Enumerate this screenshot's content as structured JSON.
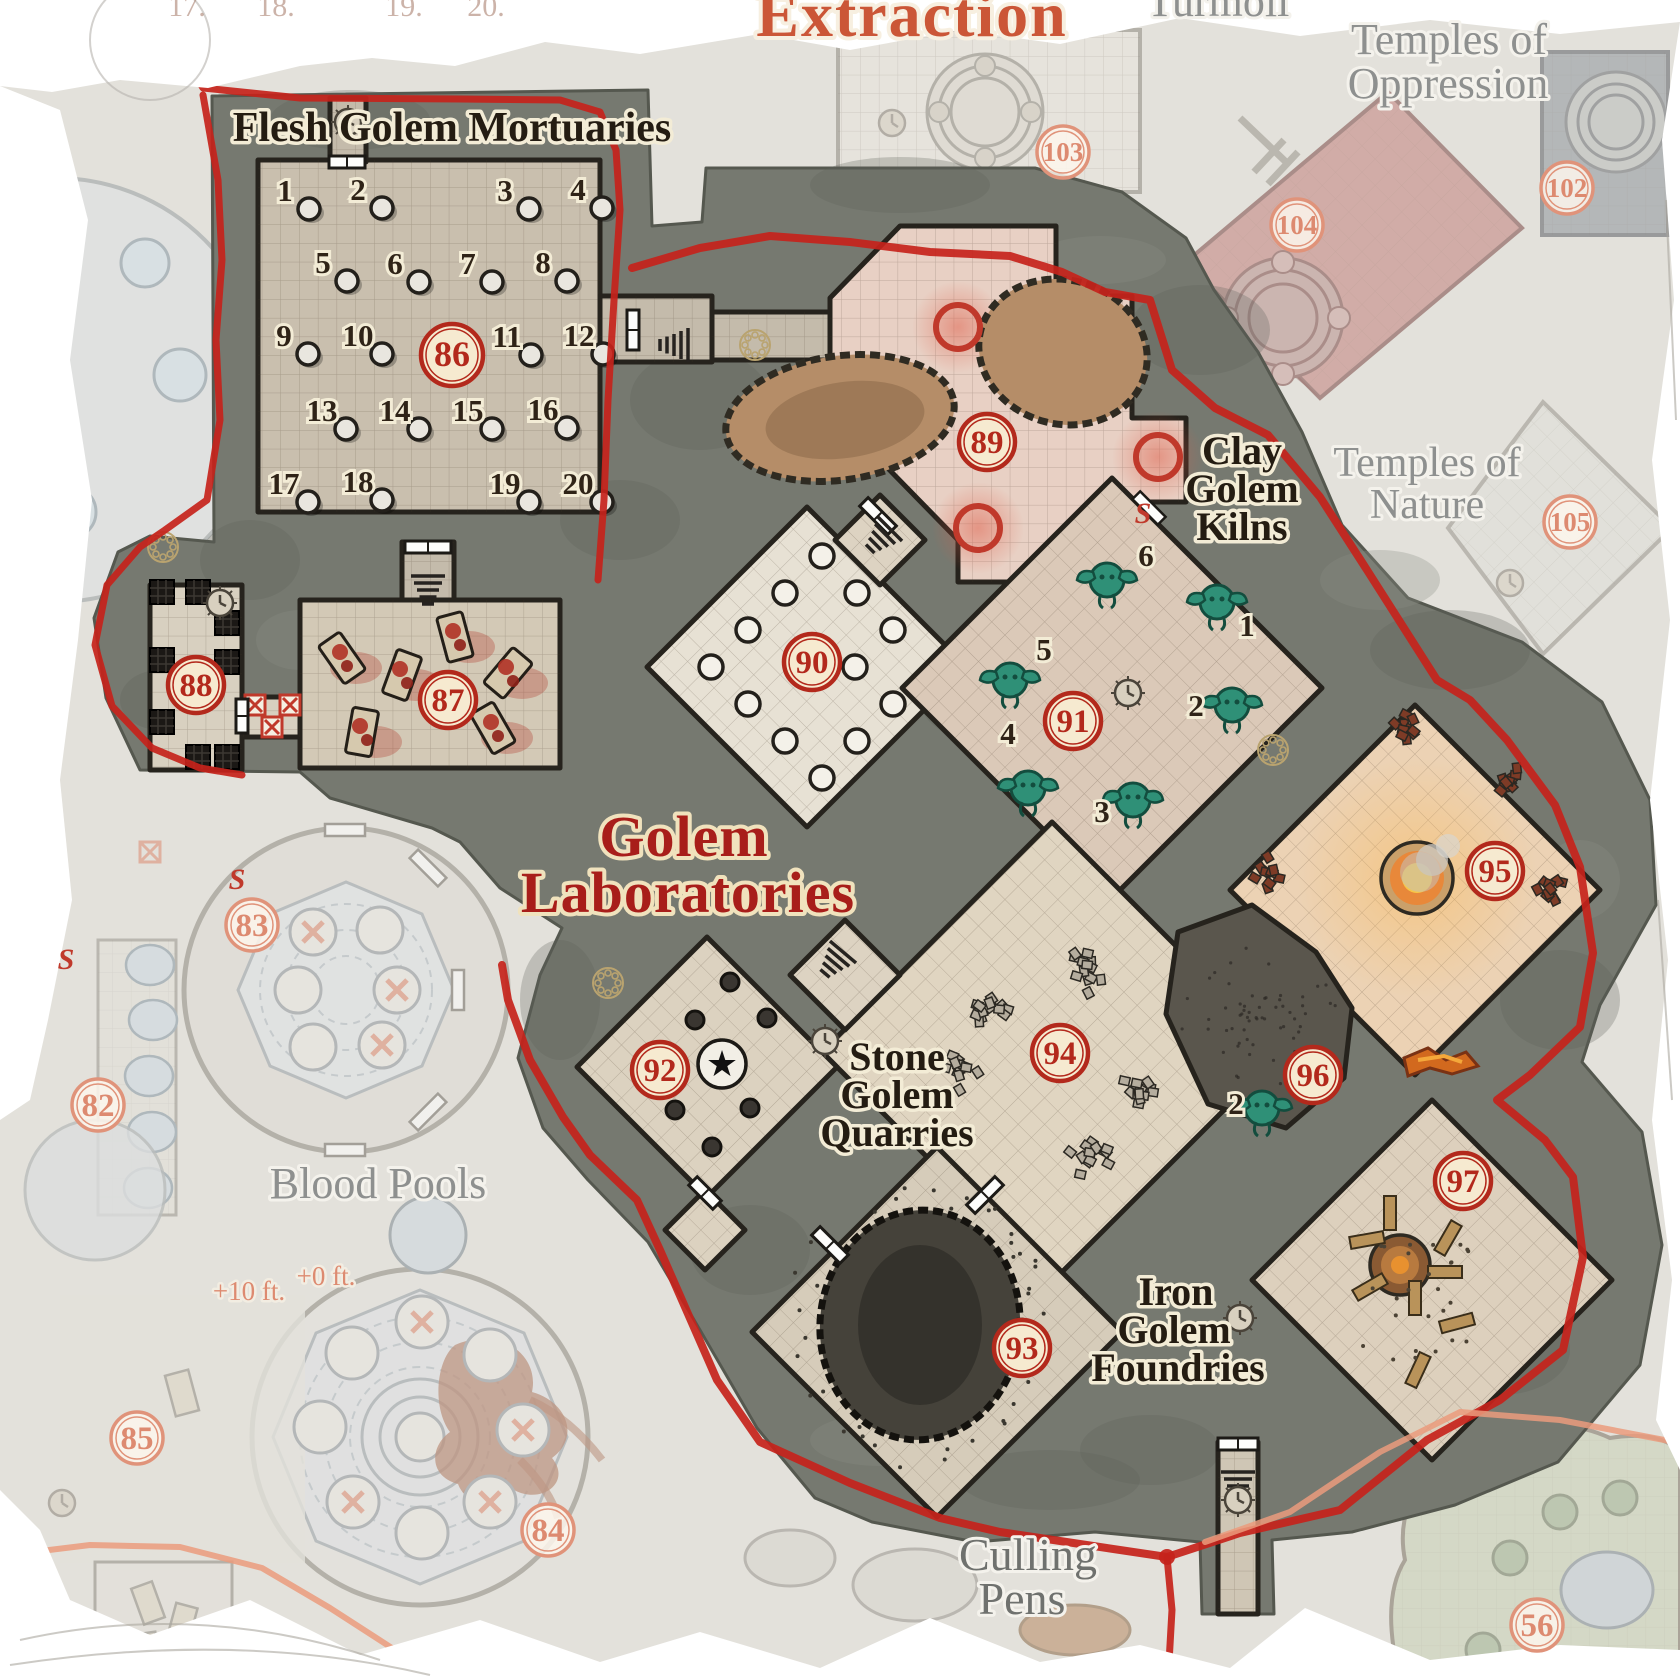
{
  "map": {
    "title": "Golem Laboratories",
    "type": "dungeon-battle-map"
  },
  "colors": {
    "marker_red": "#b3291c",
    "marker_cream": "#f6ead0",
    "faded_salmon": "#dd8a70",
    "boundary_red": "#c5231b",
    "boundary_salmon": "#eb9b7d",
    "title_red": "#a81e1a",
    "label_dark": "#241c12",
    "label_gray": "#8e908f",
    "stone": "#767970",
    "floor_tan": "#cfc5b3",
    "floor_pink": "#e8d0c4",
    "floor_warm": "#ecd2b4",
    "golem_teal": "#2f9077",
    "pool_blue": "#ccd9e2"
  },
  "labels": [
    {
      "name": "extraction",
      "cls": "l-gothic-o",
      "size": 64,
      "lines": [
        {
          "t": "Extraction",
          "x": 912,
          "y": 36
        }
      ]
    },
    {
      "name": "turmoil",
      "cls": "l-gray",
      "size": 44,
      "lines": [
        {
          "t": "Turmoil",
          "x": 1218,
          "y": 16
        }
      ]
    },
    {
      "name": "temples-of-oppression",
      "cls": "l-gray",
      "size": 44,
      "lines": [
        {
          "t": "Temples of",
          "x": 1449,
          "y": 54
        },
        {
          "t": "Oppression",
          "x": 1448,
          "y": 98
        }
      ]
    },
    {
      "name": "temples-of-nature",
      "cls": "l-gray",
      "size": 42,
      "lines": [
        {
          "t": "Temples of",
          "x": 1427,
          "y": 476
        },
        {
          "t": "Nature",
          "x": 1427,
          "y": 518
        }
      ]
    },
    {
      "name": "flesh-golem-mortuaries",
      "cls": "l-dark",
      "size": 42,
      "lines": [
        {
          "t": "Flesh Golem Mortuaries",
          "x": 452,
          "y": 141
        }
      ]
    },
    {
      "name": "clay-golem-kilns",
      "cls": "l-dark",
      "size": 40,
      "lines": [
        {
          "t": "Clay",
          "x": 1242,
          "y": 464
        },
        {
          "t": "Golem",
          "x": 1242,
          "y": 502
        },
        {
          "t": "Kilns",
          "x": 1242,
          "y": 540
        }
      ]
    },
    {
      "name": "map-title",
      "cls": "l-gothic",
      "size": 58,
      "lines": [
        {
          "t": "Golem",
          "x": 684,
          "y": 856
        },
        {
          "t": "Laboratories",
          "x": 688,
          "y": 912
        }
      ]
    },
    {
      "name": "stone-golem-quarries",
      "cls": "l-dark",
      "size": 40,
      "lines": [
        {
          "t": "Stone",
          "x": 897,
          "y": 1070
        },
        {
          "t": "Golem",
          "x": 897,
          "y": 1108
        },
        {
          "t": "Quarries",
          "x": 897,
          "y": 1146
        }
      ]
    },
    {
      "name": "iron-golem-foundries",
      "cls": "l-dark",
      "size": 40,
      "lines": [
        {
          "t": "Iron",
          "x": 1176,
          "y": 1305
        },
        {
          "t": "Golem",
          "x": 1174,
          "y": 1343
        },
        {
          "t": "Foundries",
          "x": 1178,
          "y": 1381
        }
      ]
    },
    {
      "name": "culling-pens",
      "cls": "l-graydark",
      "size": 46,
      "lines": [
        {
          "t": "Culling",
          "x": 1028,
          "y": 1570
        },
        {
          "t": "Pens",
          "x": 1022,
          "y": 1614
        }
      ]
    },
    {
      "name": "blood-pools",
      "cls": "l-gray",
      "size": 44,
      "lines": [
        {
          "t": "Blood Pools",
          "x": 378,
          "y": 1198
        }
      ]
    },
    {
      "name": "elevation-plus-10",
      "cls": "l-salmon",
      "size": 27,
      "lines": [
        {
          "t": "+10 ft.",
          "x": 249,
          "y": 1300
        }
      ]
    },
    {
      "name": "elevation-plus-0",
      "cls": "l-salmon",
      "size": 27,
      "lines": [
        {
          "t": "+0 ft.",
          "x": 326,
          "y": 1285
        }
      ]
    }
  ],
  "ghost_numbers": [
    {
      "t": "17.",
      "x": 187
    },
    {
      "t": "18.",
      "x": 276
    },
    {
      "t": "19.",
      "x": 404
    },
    {
      "t": "20.",
      "x": 486
    }
  ],
  "rooms": [
    {
      "number": "82",
      "x": 98,
      "y": 1105,
      "faded": true
    },
    {
      "number": "83",
      "x": 252,
      "y": 925,
      "faded": true
    },
    {
      "number": "84",
      "x": 548,
      "y": 1530,
      "faded": true
    },
    {
      "number": "85",
      "x": 137,
      "y": 1438,
      "faded": true
    },
    {
      "number": "86",
      "x": 452,
      "y": 355,
      "faded": false
    },
    {
      "number": "87",
      "x": 448,
      "y": 700,
      "faded": false
    },
    {
      "number": "88",
      "x": 196,
      "y": 685,
      "faded": false
    },
    {
      "number": "89",
      "x": 987,
      "y": 442,
      "faded": false
    },
    {
      "number": "90",
      "x": 812,
      "y": 662,
      "faded": false
    },
    {
      "number": "91",
      "x": 1073,
      "y": 721,
      "faded": false
    },
    {
      "number": "92",
      "x": 660,
      "y": 1070,
      "faded": false
    },
    {
      "number": "93",
      "x": 1022,
      "y": 1348,
      "faded": false
    },
    {
      "number": "94",
      "x": 1060,
      "y": 1053,
      "faded": false
    },
    {
      "number": "95",
      "x": 1495,
      "y": 871,
      "faded": false
    },
    {
      "number": "96",
      "x": 1313,
      "y": 1075,
      "faded": false
    },
    {
      "number": "97",
      "x": 1463,
      "y": 1181,
      "faded": false
    },
    {
      "number": "102",
      "x": 1567,
      "y": 188,
      "faded": true
    },
    {
      "number": "103",
      "x": 1063,
      "y": 152,
      "faded": true
    },
    {
      "number": "104",
      "x": 1297,
      "y": 225,
      "faded": true
    },
    {
      "number": "105",
      "x": 1570,
      "y": 522,
      "faded": true
    },
    {
      "number": "56",
      "x": 1537,
      "y": 1625,
      "faded": true
    }
  ],
  "mortuary": {
    "slabs": [
      {
        "n": "1",
        "x": 309,
        "y": 209
      },
      {
        "n": "2",
        "x": 382,
        "y": 208
      },
      {
        "n": "3",
        "x": 529,
        "y": 209
      },
      {
        "n": "4",
        "x": 602,
        "y": 208
      },
      {
        "n": "5",
        "x": 347,
        "y": 281
      },
      {
        "n": "6",
        "x": 419,
        "y": 282
      },
      {
        "n": "7",
        "x": 492,
        "y": 282
      },
      {
        "n": "8",
        "x": 567,
        "y": 281
      },
      {
        "n": "9",
        "x": 308,
        "y": 354
      },
      {
        "n": "10",
        "x": 382,
        "y": 354
      },
      {
        "n": "11",
        "x": 531,
        "y": 355
      },
      {
        "n": "12",
        "x": 603,
        "y": 354
      },
      {
        "n": "13",
        "x": 346,
        "y": 429
      },
      {
        "n": "14",
        "x": 419,
        "y": 429
      },
      {
        "n": "15",
        "x": 492,
        "y": 429
      },
      {
        "n": "16",
        "x": 567,
        "y": 428
      },
      {
        "n": "17",
        "x": 308,
        "y": 502
      },
      {
        "n": "18",
        "x": 382,
        "y": 500
      },
      {
        "n": "19",
        "x": 529,
        "y": 502
      },
      {
        "n": "20",
        "x": 602,
        "y": 502
      }
    ]
  },
  "kilns": {
    "golems": [
      {
        "n": "6",
        "x": 1107,
        "y": 580,
        "lx": 1146,
        "ly": 566
      },
      {
        "n": "1",
        "x": 1217,
        "y": 602,
        "lx": 1247,
        "ly": 636
      },
      {
        "n": "5",
        "x": 1010,
        "y": 680,
        "lx": 1044,
        "ly": 660
      },
      {
        "n": "2",
        "x": 1232,
        "y": 705,
        "lx": 1196,
        "ly": 716
      },
      {
        "n": "4",
        "x": 1028,
        "y": 788,
        "lx": 1008,
        "ly": 744
      },
      {
        "n": "3",
        "x": 1133,
        "y": 800,
        "lx": 1102,
        "ly": 822
      },
      {
        "n": "2",
        "x": 1262,
        "y": 1108,
        "lx": 1236,
        "ly": 1114
      }
    ]
  },
  "secret_doors": [
    {
      "s": "S",
      "x": 1143,
      "y": 514,
      "faded": false
    },
    {
      "s": "S",
      "x": 237,
      "y": 880,
      "faded": true
    },
    {
      "s": "S",
      "x": 66,
      "y": 960,
      "faded": true
    }
  ],
  "party_marker": {
    "symbol": "★",
    "x": 722,
    "y": 1064
  }
}
